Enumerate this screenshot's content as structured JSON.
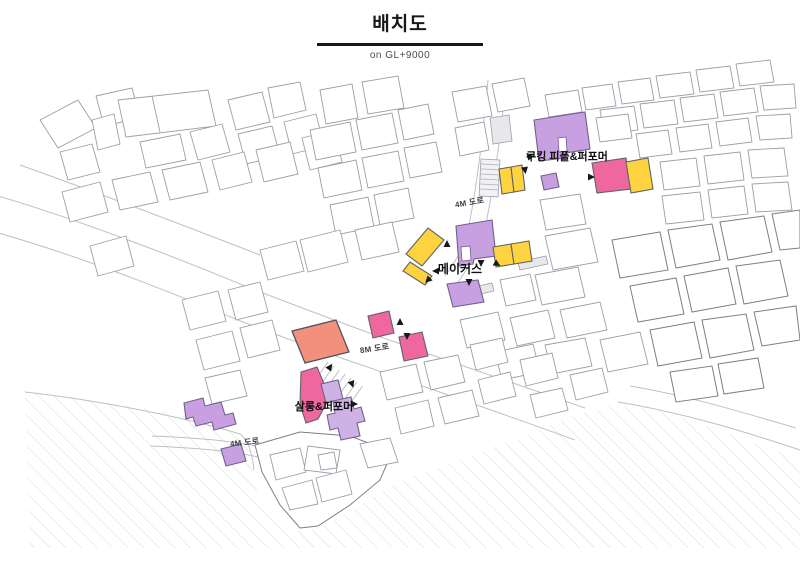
{
  "header": {
    "title": "배치도",
    "subtitle": "on GL+9000"
  },
  "map": {
    "labels": {
      "cooking": "쿠킹 피플&퍼포머",
      "makers": "메이커스",
      "salon": "살롱&퍼포머",
      "road_4m_top": "4M 도로",
      "road_8m": "8M 도로",
      "road_4m_bottom": "4M 도로"
    },
    "zones": [
      {
        "id": "cooking",
        "label": "쿠킹 피플&퍼포머"
      },
      {
        "id": "makers",
        "label": "메이커스"
      },
      {
        "id": "salon",
        "label": "살롱&퍼포머"
      }
    ],
    "colors": {
      "yellow": "#FFD23F",
      "pink": "#EE679E",
      "salmon": "#F2907B",
      "purple": "#C8A0E2",
      "purple_light": "#CDB2E6",
      "outline": "#5f6368",
      "map_line": "#9aa0a8",
      "map_line_dark": "#7a7f88",
      "hatch": "#d8dadd"
    }
  }
}
